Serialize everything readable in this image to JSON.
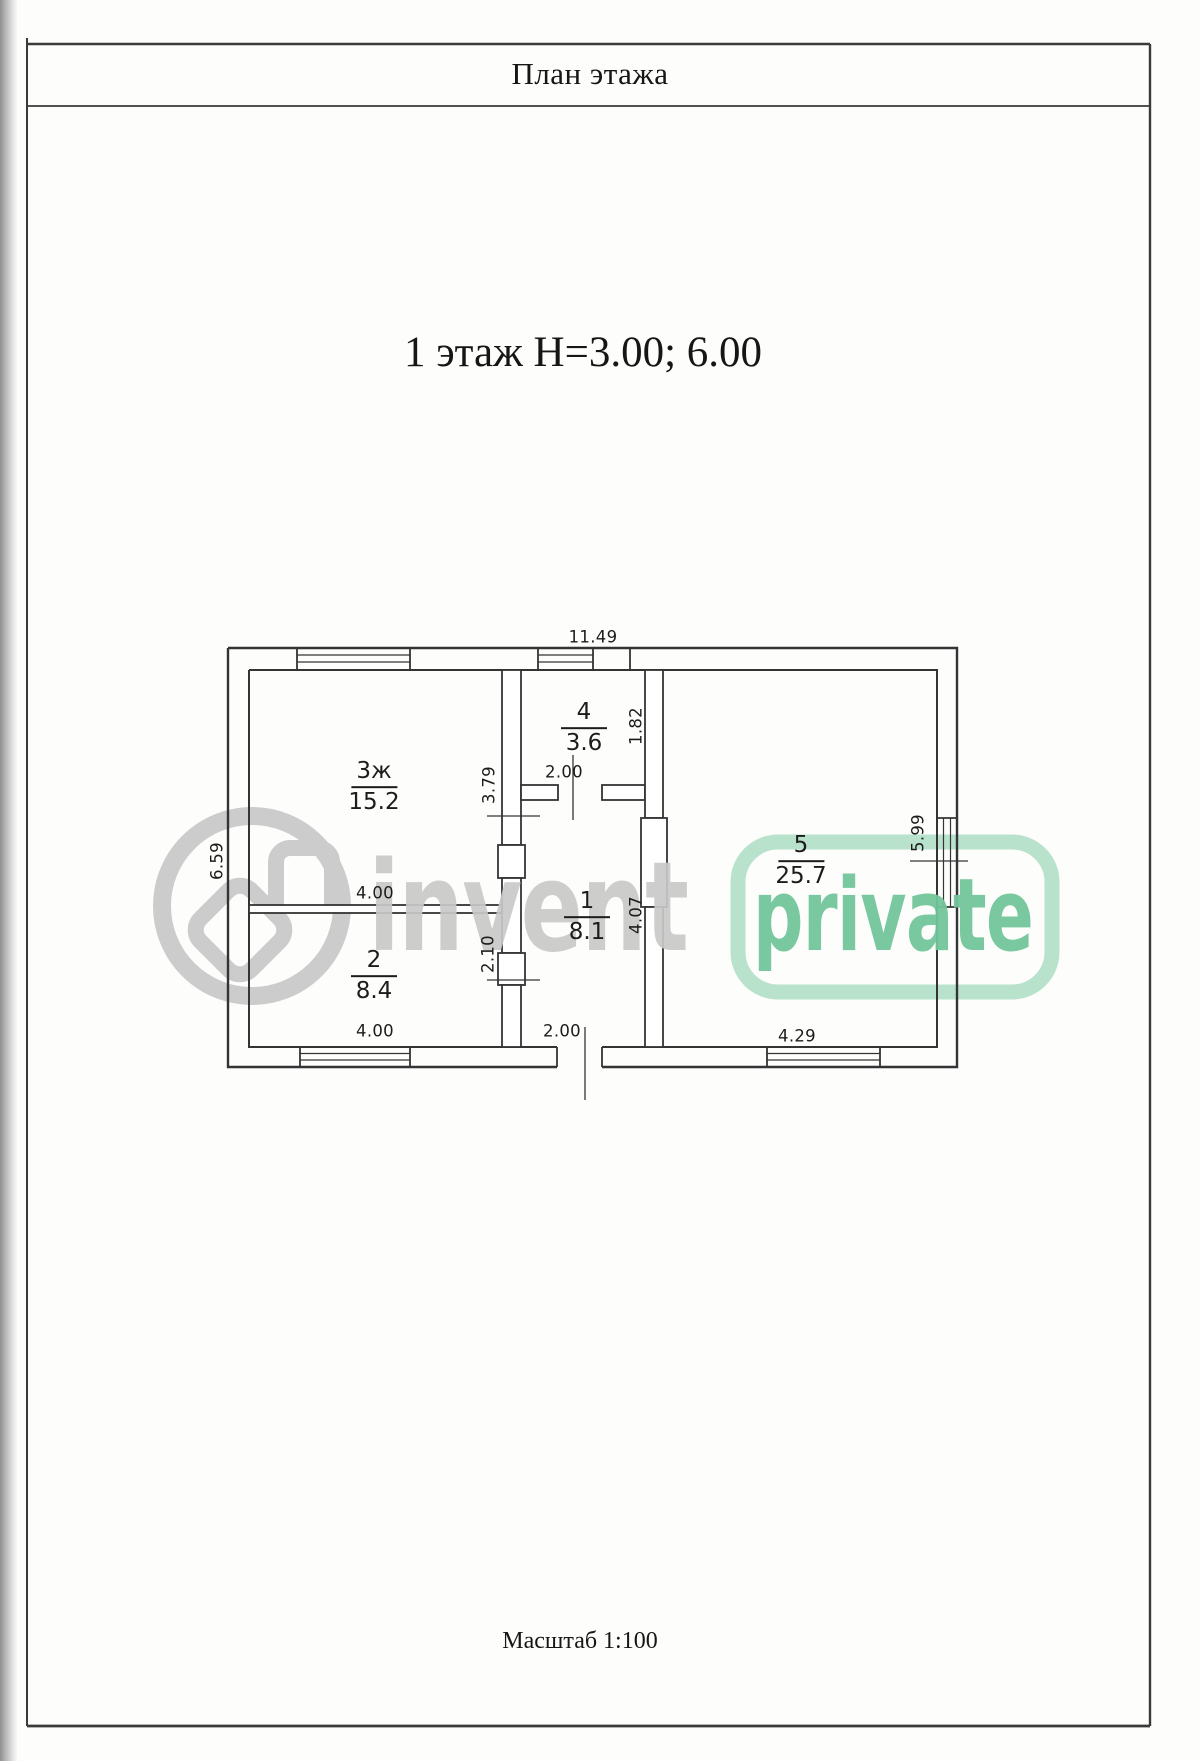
{
  "page": {
    "title": "План этажа",
    "heading": "1 этаж Н=3.00; 6.00",
    "scale_note": "Масштаб 1:100"
  },
  "watermark": {
    "brand": "invent",
    "badge": "private",
    "brand_color": "#c9c9c9",
    "badge_text_color": "#72c69b",
    "badge_outline_color": "#b9e2cd"
  },
  "plan": {
    "rooms": [
      {
        "number": "3ж",
        "area": "15.2"
      },
      {
        "number": "2",
        "area": "8.4"
      },
      {
        "number": "4",
        "area": "3.6"
      },
      {
        "number": "1",
        "area": "8.1"
      },
      {
        "number": "5",
        "area": "25.7"
      }
    ],
    "dims": {
      "overall_top": "11.49",
      "overall_left": "6.59",
      "room3_right": "3.79",
      "room3_bottom": "4.00",
      "room4_bottom": "2.00",
      "room4_right": "1.82",
      "hall_left": "2.10",
      "hall_right": "4.07",
      "room2_bottom": "4.00",
      "entry_bottom": "2.00",
      "room5_bottom": "4.29",
      "room5_right": "5.99"
    }
  }
}
